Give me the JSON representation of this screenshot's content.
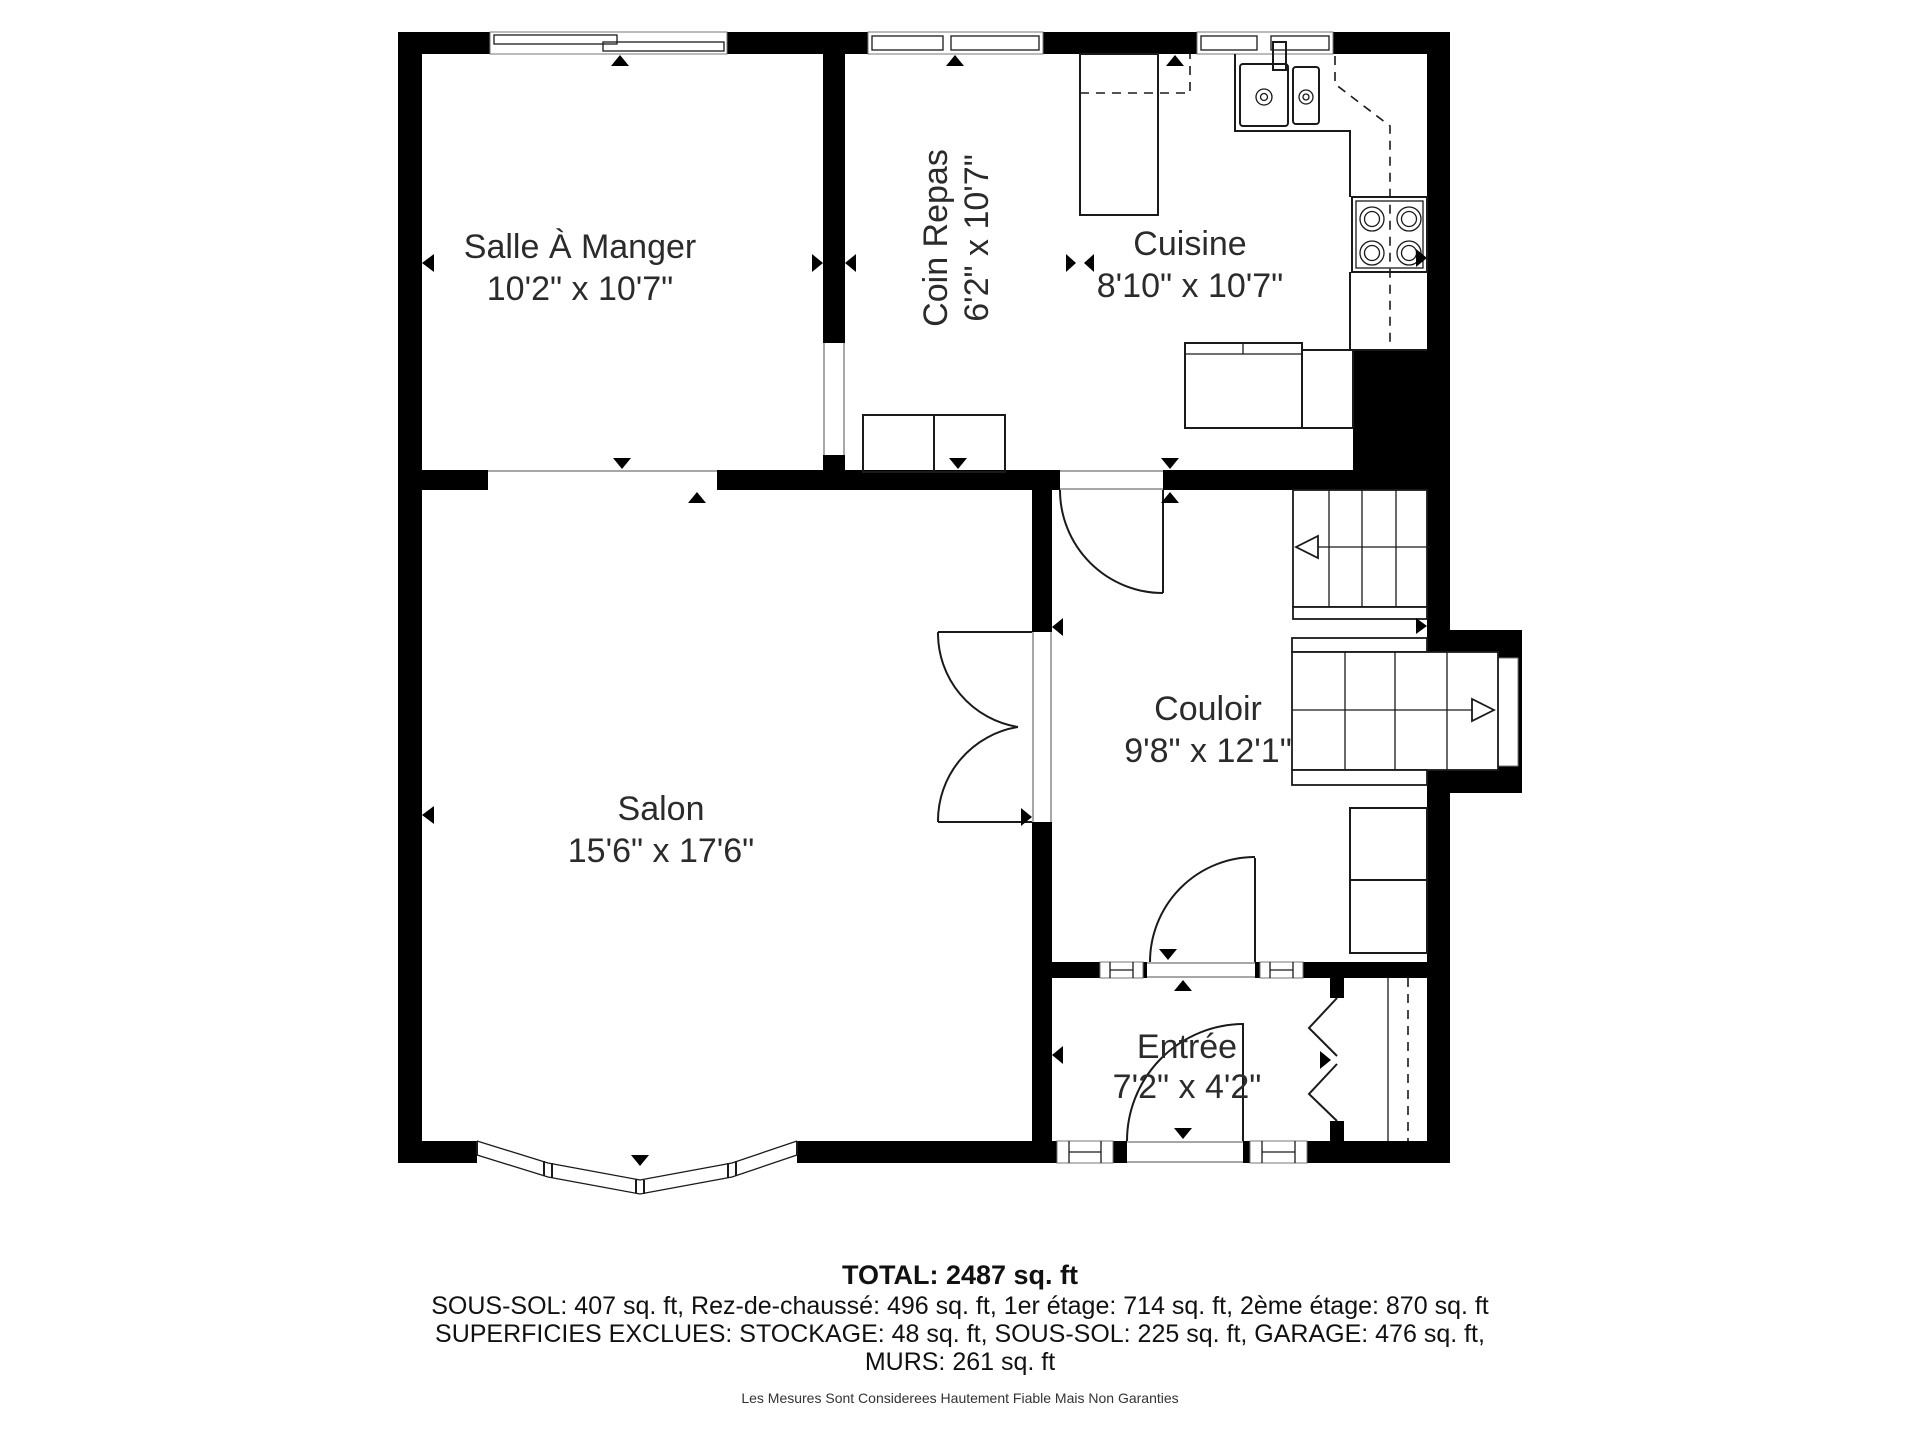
{
  "plan": {
    "rooms": [
      {
        "name": "Salle À Manger",
        "dims": "10'2\" x 10'7\""
      },
      {
        "name": "Coin Repas",
        "dims": "6'2\" x 10'7\""
      },
      {
        "name": "Cuisine",
        "dims": "8'10\" x 10'7\""
      },
      {
        "name": "Couloir",
        "dims": "9'8\" x 12'1\""
      },
      {
        "name": "Salon",
        "dims": "15'6\" x 17'6\""
      },
      {
        "name": "Entrée",
        "dims": "7'2\" x 4'2\""
      }
    ]
  },
  "summary": {
    "total": "TOTAL: 2487 sq. ft",
    "floors": "SOUS-SOL: 407 sq. ft, Rez-de-chaussé: 496 sq. ft, 1er étage: 714 sq. ft, 2ème étage: 870 sq. ft",
    "exclusions": "SUPERFICIES EXCLUES: STOCKAGE: 48 sq. ft, SOUS-SOL: 225 sq. ft, GARAGE: 476 sq. ft,",
    "walls": "MURS: 261 sq. ft",
    "disclaimer": "Les Mesures Sont Considerees Hautement Fiable Mais Non Garanties"
  }
}
